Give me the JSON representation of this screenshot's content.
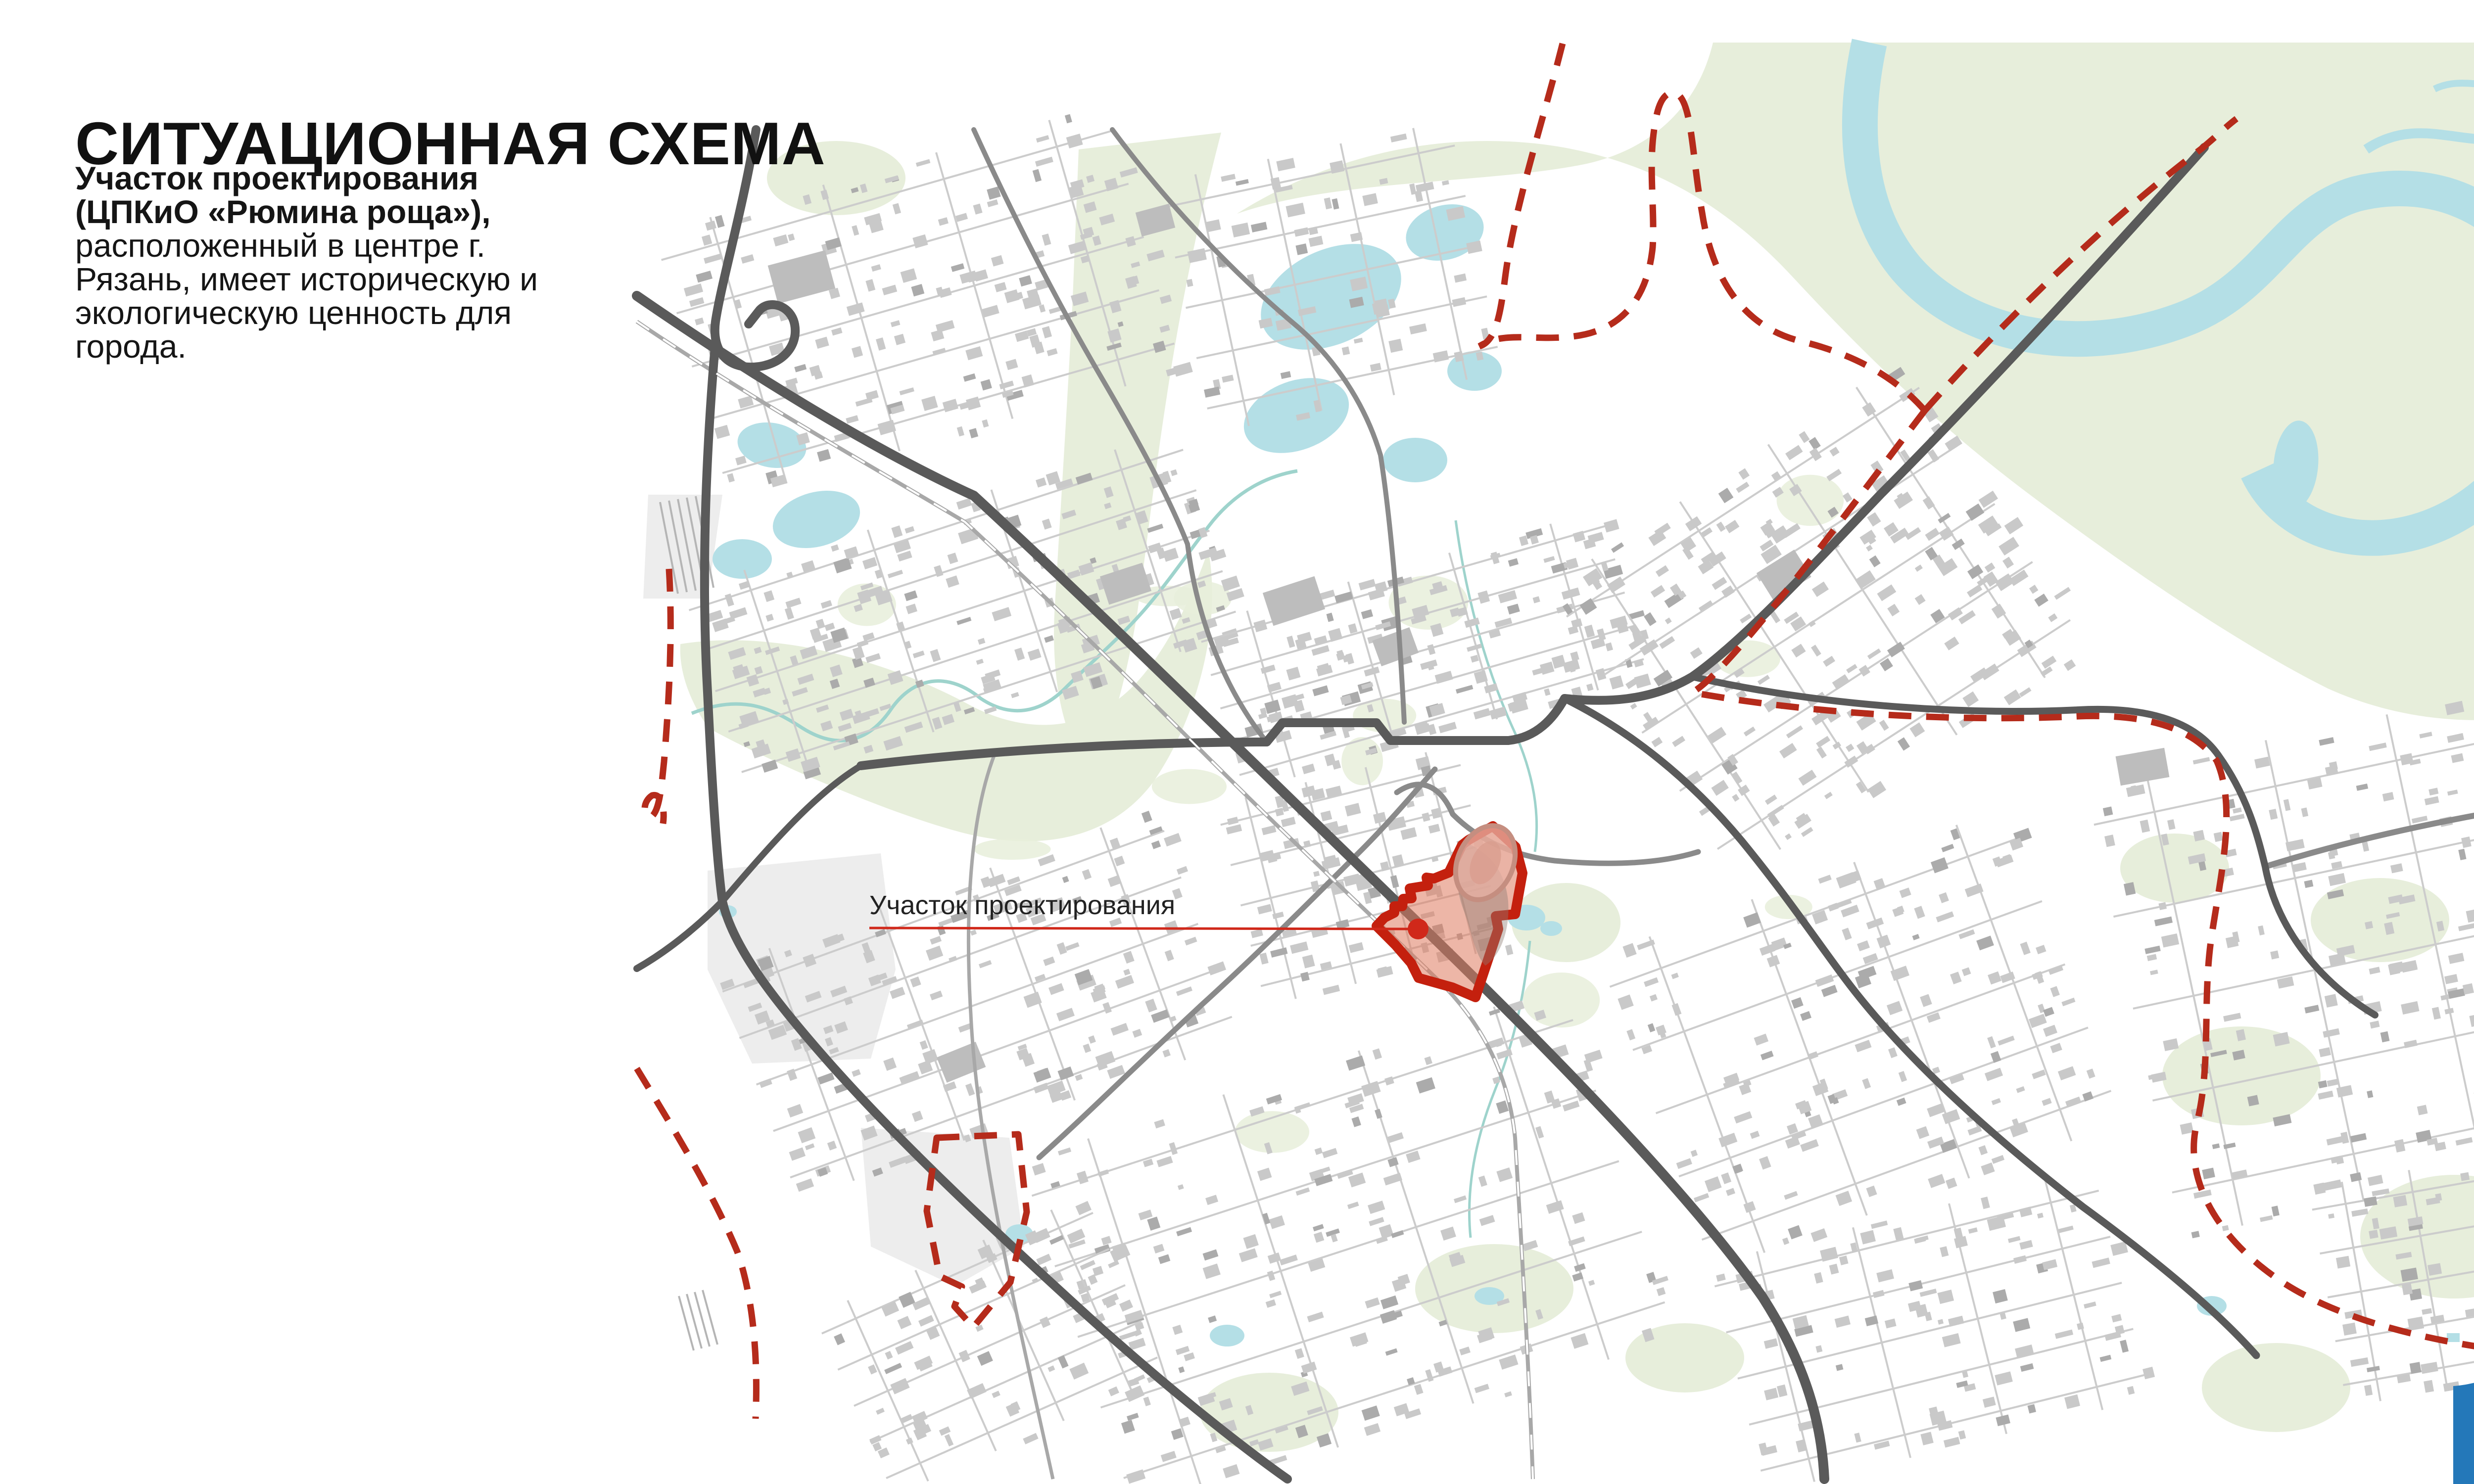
{
  "page": {
    "title": "СИТУАЦИОННАЯ СХЕМА",
    "page_number": "1"
  },
  "intro": {
    "lines": [
      {
        "text": "Участок проектирования",
        "bold": true
      },
      {
        "text": "(ЦПКиО «Рюмина роща»),",
        "bold": true
      },
      {
        "text": "расположенный в центре г.",
        "bold": false
      },
      {
        "text": "Рязань, имеет историческую и",
        "bold": false
      },
      {
        "text": "экологическую ценность для",
        "bold": false
      },
      {
        "text": "города.",
        "bold": false
      }
    ]
  },
  "map": {
    "site_label": "Участок проектирования"
  },
  "colors": {
    "accent_red": "#c4200e",
    "boundary_red": "#b52b1b",
    "leader_red": "#d0281a",
    "water_blue": "#b4dfe6",
    "green_area": "#e7eedb",
    "road_dark_gray": "#5a5a5a",
    "building_gray": "#c9c9c9",
    "badge_blue": "#2478b9"
  }
}
